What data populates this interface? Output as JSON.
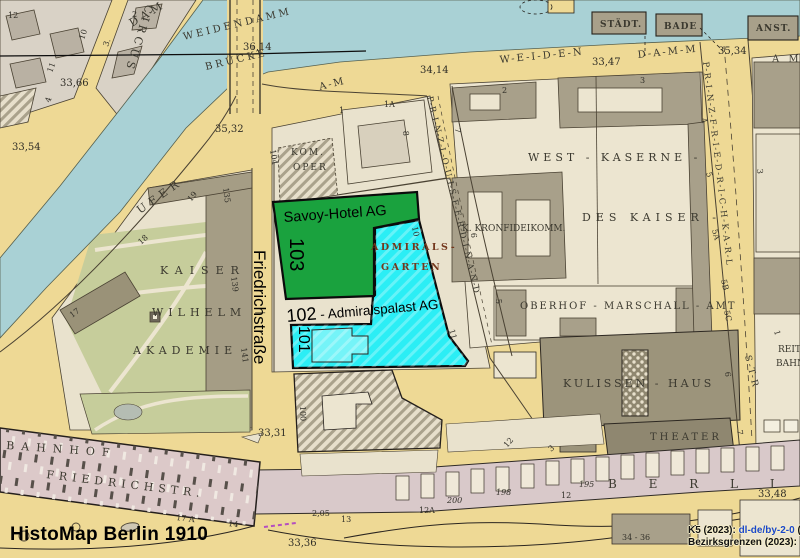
{
  "app": {
    "title_overlay": "HistoMap Berlin 1910"
  },
  "attribution": {
    "line1_prefix": "K5 (2023): ",
    "line1_link": "dl-de/by-2-0",
    "line1_suffix": " (",
    "line2_prefix": "Bezirksgrenzen (2023):",
    "link_color": "#1a47cc"
  },
  "overlay": {
    "street_modern": "Friedrichstraße",
    "parcels": {
      "p103": {
        "number": "103",
        "name": "Savoy-Hotel AG",
        "color": "#1aa23e"
      },
      "p102": {
        "number": "102",
        "suffix": " - Admiralspalast AG",
        "color": "#2beef5"
      },
      "p101": {
        "number": "101",
        "color": "#2beef5"
      }
    }
  },
  "streets": {
    "circus": "CIRCUS",
    "dam": "DAM",
    "weidendammer": "WEIDENDAMMER",
    "bruecke": "BRÜCKE",
    "weiden": "W-E-I-D-E-N",
    "damm": "D-A-M-M",
    "am_mid": "A-M",
    "am_right": "A M",
    "prinz_louis_ferdinand": "P-R-I-N-Z-L-O-U-I-S-F-E-R-D-I-N-A-N-D",
    "prinz_friedrich_karl": "P-R-I-N-Z-F-R-I-E-D-R-I-C-H-K-A-R-L",
    "str": "S-T-R",
    "ufer": "UFER",
    "bahnhof": "BAHNHOF",
    "friedrichstr_old": "FRIEDRICHSTR."
  },
  "places": {
    "kaiser": "KAISER",
    "wilhelm": "WILHELM —",
    "akademie": "AKADEMIE",
    "kom": "KOM.",
    "oper": "OPER",
    "west_kaserne": "WEST - KASERNE -",
    "des_kaiser": "DES KAISER -",
    "kronfideikomm": "K. KRONFIDEIKOMM.",
    "oberhof": "OBERHOF - MARSCHALL - AMT",
    "kulissen": "KULISSEN - HAUS",
    "theater": "THEATER",
    "reit": "REIT",
    "bahn": "BAHN",
    "admirals": "ADMIRALS-",
    "garten": "GARTEN",
    "staedt": "STÄDT.",
    "bade": "BADE",
    "anst": "ANST.",
    "berli": "B E R L I"
  },
  "elevations": {
    "e1": "33,66",
    "e2": "33,54",
    "e3": "35,32",
    "e4": "36,14",
    "e5": "34,14",
    "e6": "33,47",
    "e7": "35,34",
    "e8": "33,31",
    "e9": "33,36",
    "e10": "33,48"
  },
  "numbers": {
    "k12": "12",
    "k10": "10",
    "k3a": "3.",
    "k11": "11",
    "k4a": "4",
    "k2a": "2",
    "k18": "18",
    "k19": "19",
    "k135": "135",
    "k139": "139",
    "k141": "141",
    "k17": "17",
    "k104": "104",
    "k1": "1",
    "k1A": "1A",
    "k8": "8",
    "k2b": "2",
    "k7a": "7",
    "k6a": "6",
    "k5a": "5",
    "k3b": "3",
    "k4b": "4",
    "k5b": "5",
    "k5A": "5A",
    "k5B": "5B",
    "k5C": "5C",
    "k3c": "3",
    "k1b": "1",
    "k6b": "6",
    "k10b": "10",
    "k11b": "11",
    "k100": "100",
    "k7b": "7",
    "k17A": "17 A",
    "k14": "14",
    "k205": "2,05",
    "k13": "13",
    "k12A": "12A",
    "k200": "200",
    "k198": "198",
    "k12b": "12",
    "k195": "195",
    "k12c": "12",
    "k3d": "3",
    "k37": "37",
    "k3436": "34 - 36"
  }
}
